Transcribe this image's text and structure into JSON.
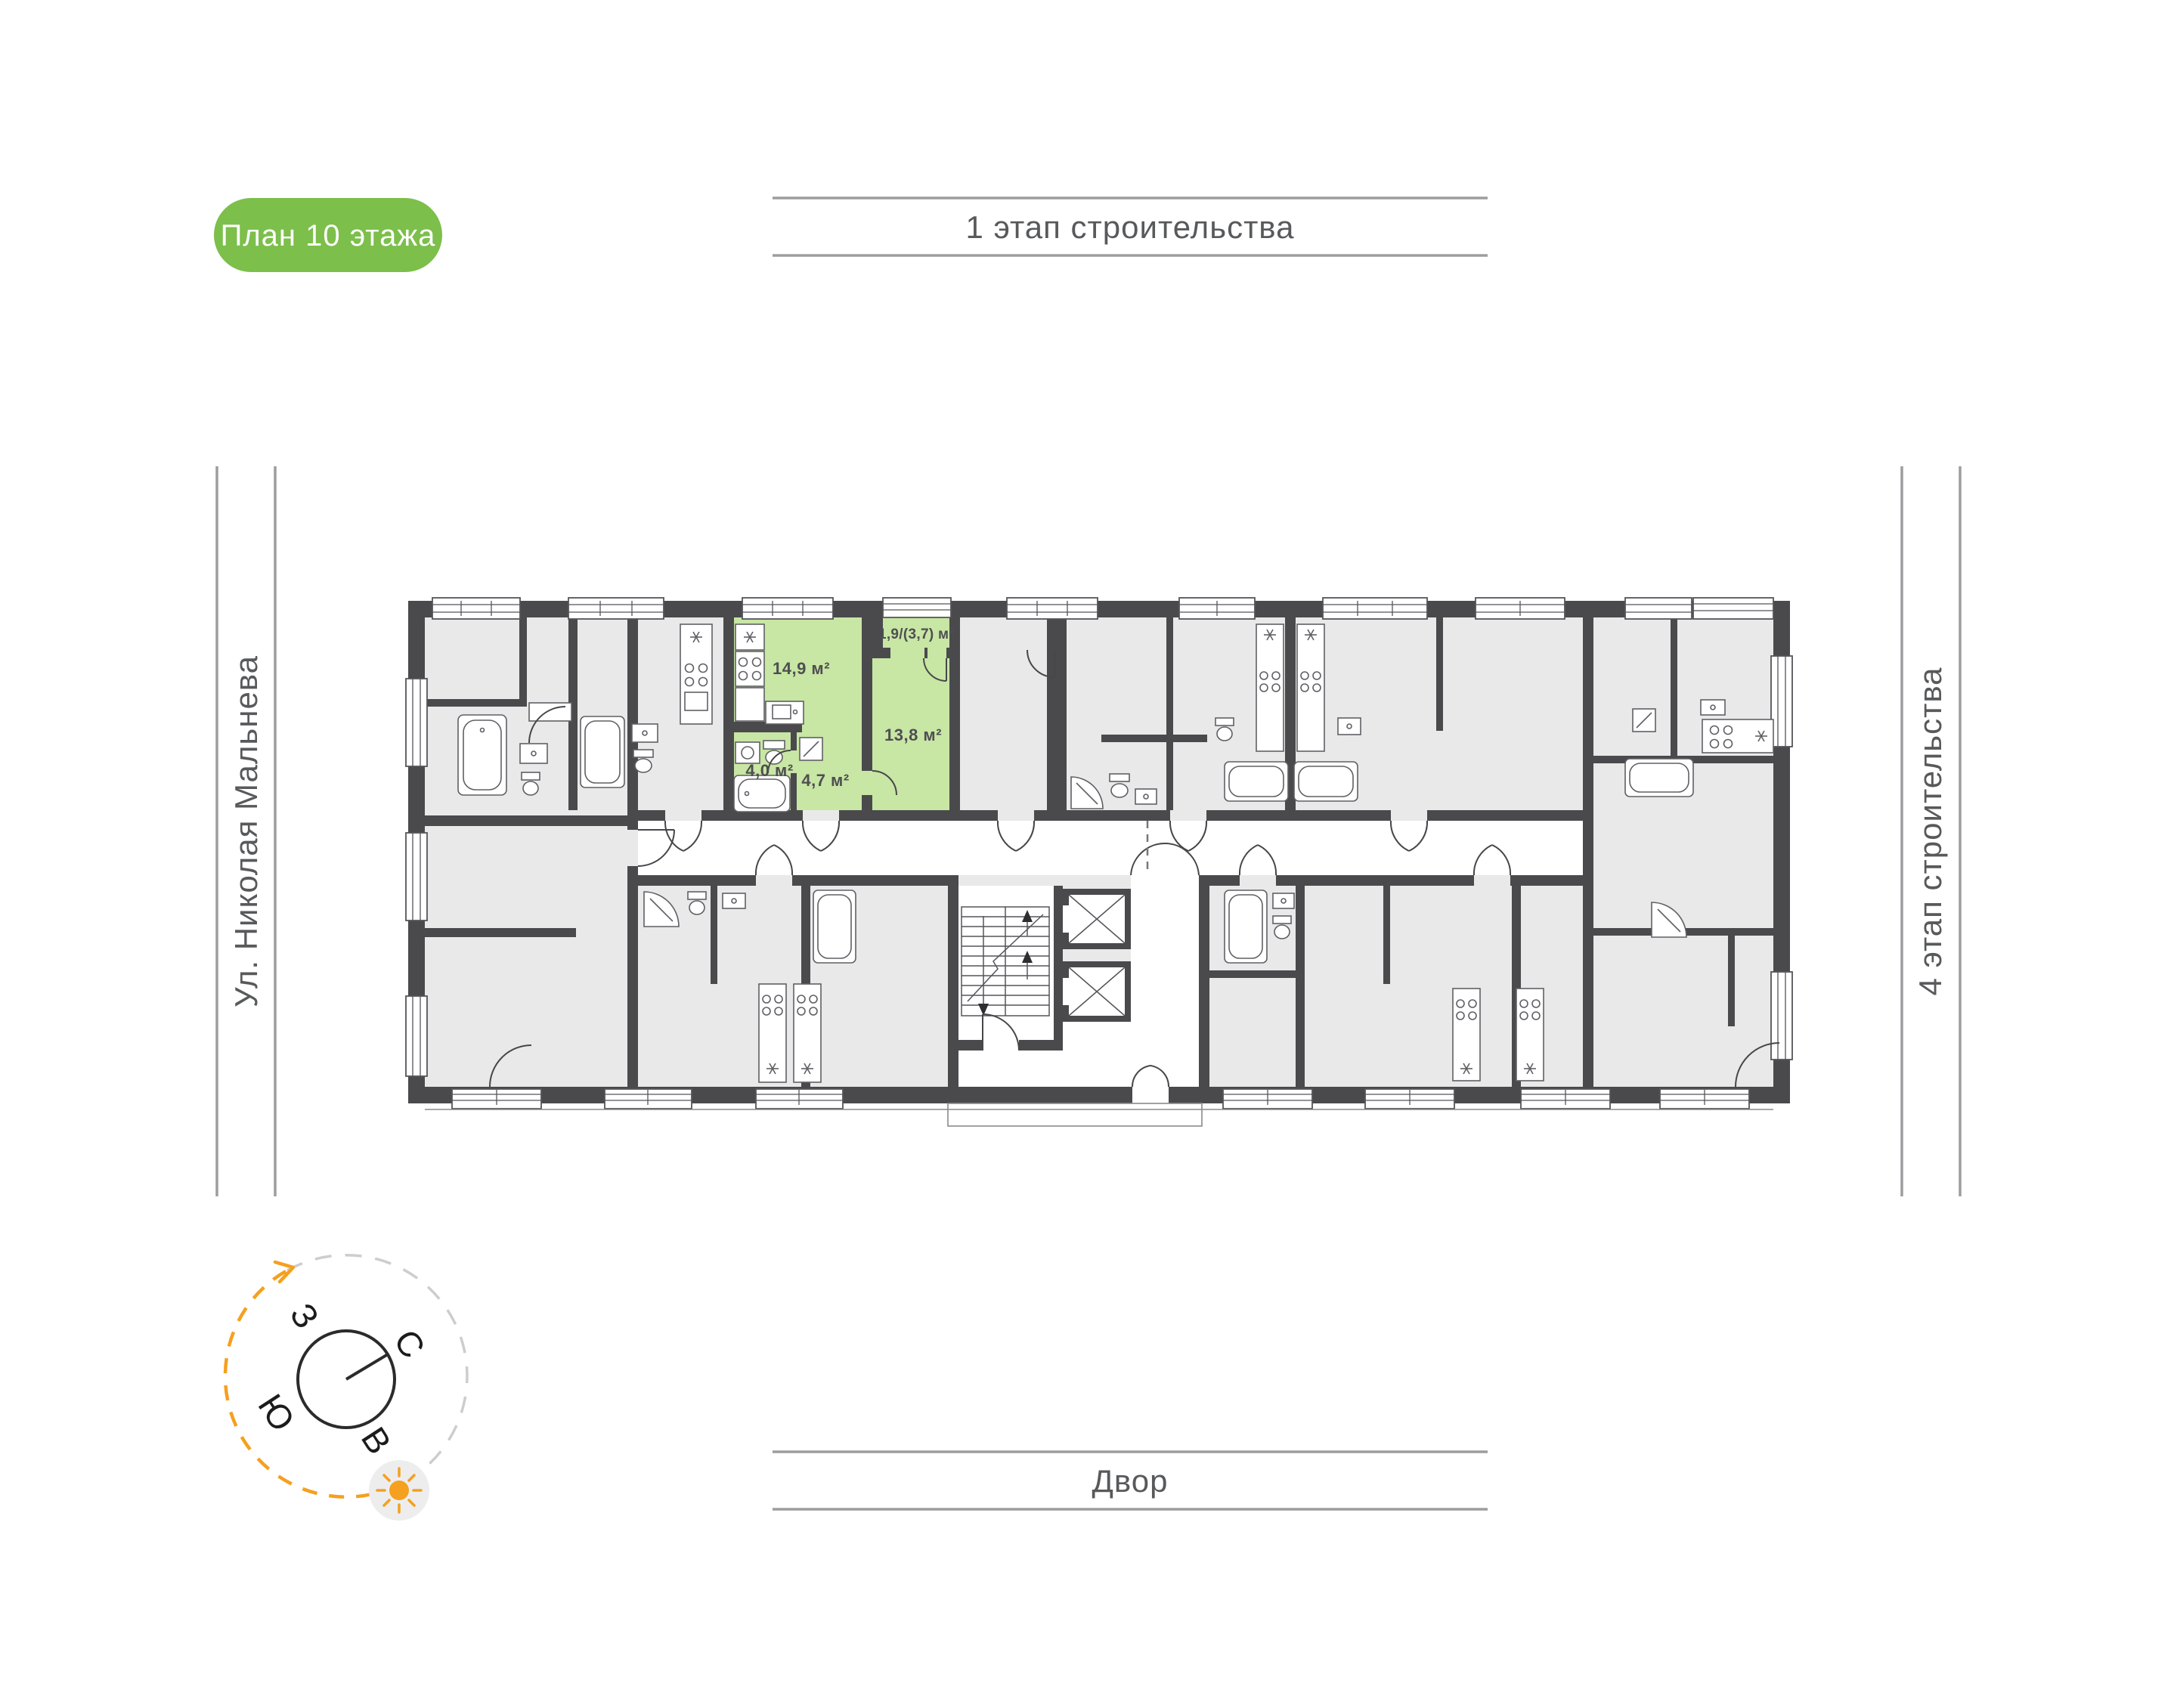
{
  "colors": {
    "badge_bg": "#7cbf4b",
    "highlight": "#c8e6a4",
    "wall": "#4a4a4d",
    "room_fill": "#e9e9ea",
    "label_text": "#58595b",
    "area_text": "#4e4e52",
    "line": "#9d9da0",
    "orange": "#f5a01f"
  },
  "badge": {
    "label": "План 10 этажа"
  },
  "surroundings": {
    "top": "1 этап строительства",
    "left": "Ул. Николая Мальнева",
    "right": "4 этап строительства",
    "bottom": "Двор"
  },
  "compass": {
    "north": "С",
    "south": "Ю",
    "west": "З",
    "east": "В"
  },
  "apartment": {
    "areas": {
      "kitchen_living": "14,9 м²",
      "balcony": "1,9/(3,7) м²",
      "room": "13,8 м²",
      "bathroom": "4,0 м²",
      "hallway": "4,7 м²"
    }
  }
}
